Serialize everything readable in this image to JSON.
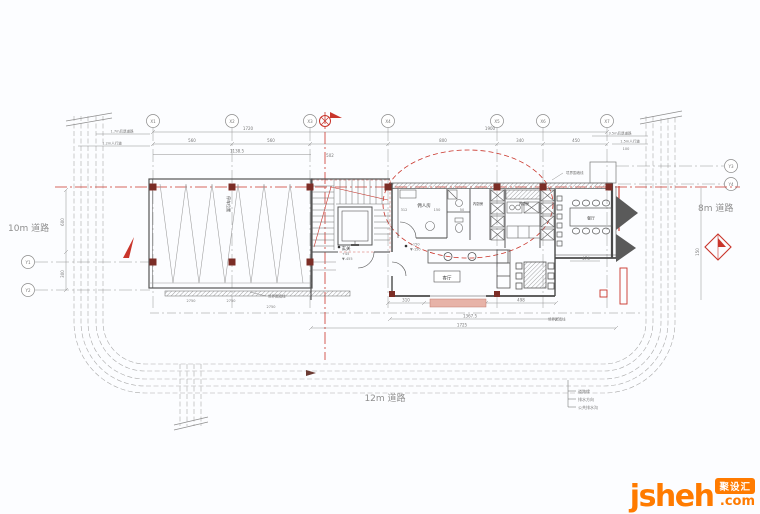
{
  "roads": {
    "left": "10m 道路",
    "right": "8m 道路",
    "bottom": "12m 道路"
  },
  "rooms": {
    "maid": "佣人房",
    "inner_kitchen_1": "内厨房",
    "inner_kitchen_2": "内厨房",
    "dining": "餐厅",
    "living": "客厅",
    "entry": "玄关",
    "parking": "停车位置"
  },
  "grid": {
    "top": [
      "X1",
      "X2",
      "X3",
      "X4",
      "X5",
      "X6",
      "X7"
    ],
    "left": [
      "Y1",
      "Y2"
    ],
    "right": [
      "Y3",
      "Y4"
    ]
  },
  "dims": {
    "d1720": "1720",
    "d1900": "1900",
    "d560a": "560",
    "d560b": "560",
    "d800": "800",
    "d340": "340",
    "d450": "450",
    "d1138": "1138.5",
    "d502": "502",
    "d312": "312",
    "d150b": "150",
    "d50": "50",
    "d310": "310",
    "d498": "498",
    "d1367": "1367.5",
    "d1725": "1725",
    "d474": "474",
    "d100": "100",
    "d600": "600",
    "d300": "300",
    "d150": "150",
    "bay1": "2750",
    "bay2": "2750",
    "bay3": "2750"
  },
  "setbacks": {
    "l1": "1.7m后退道路",
    "l2": "1.2m人行道",
    "r1": "3.5m后退道路",
    "r2": "1.5m人行道"
  },
  "marks": {
    "entry_lv1": "+45",
    "entry_lv2": "▼-455",
    "porch_lv1": "+150",
    "porch_lv2": "▼-150"
  },
  "notes": {
    "wall1": "境界围墙线",
    "wall2": "境界围墙线",
    "wall3": "境界围墙线"
  },
  "legend": {
    "items": [
      "道路缘",
      "排水方向",
      "公共排水沟"
    ]
  },
  "watermark": {
    "brand": "jsheh",
    "tld": ".com",
    "badge": "聚设汇"
  },
  "colors": {
    "accent_red": "#c9352b",
    "brand_orange": "#ff7b00",
    "ink": "#4a4a4a"
  }
}
